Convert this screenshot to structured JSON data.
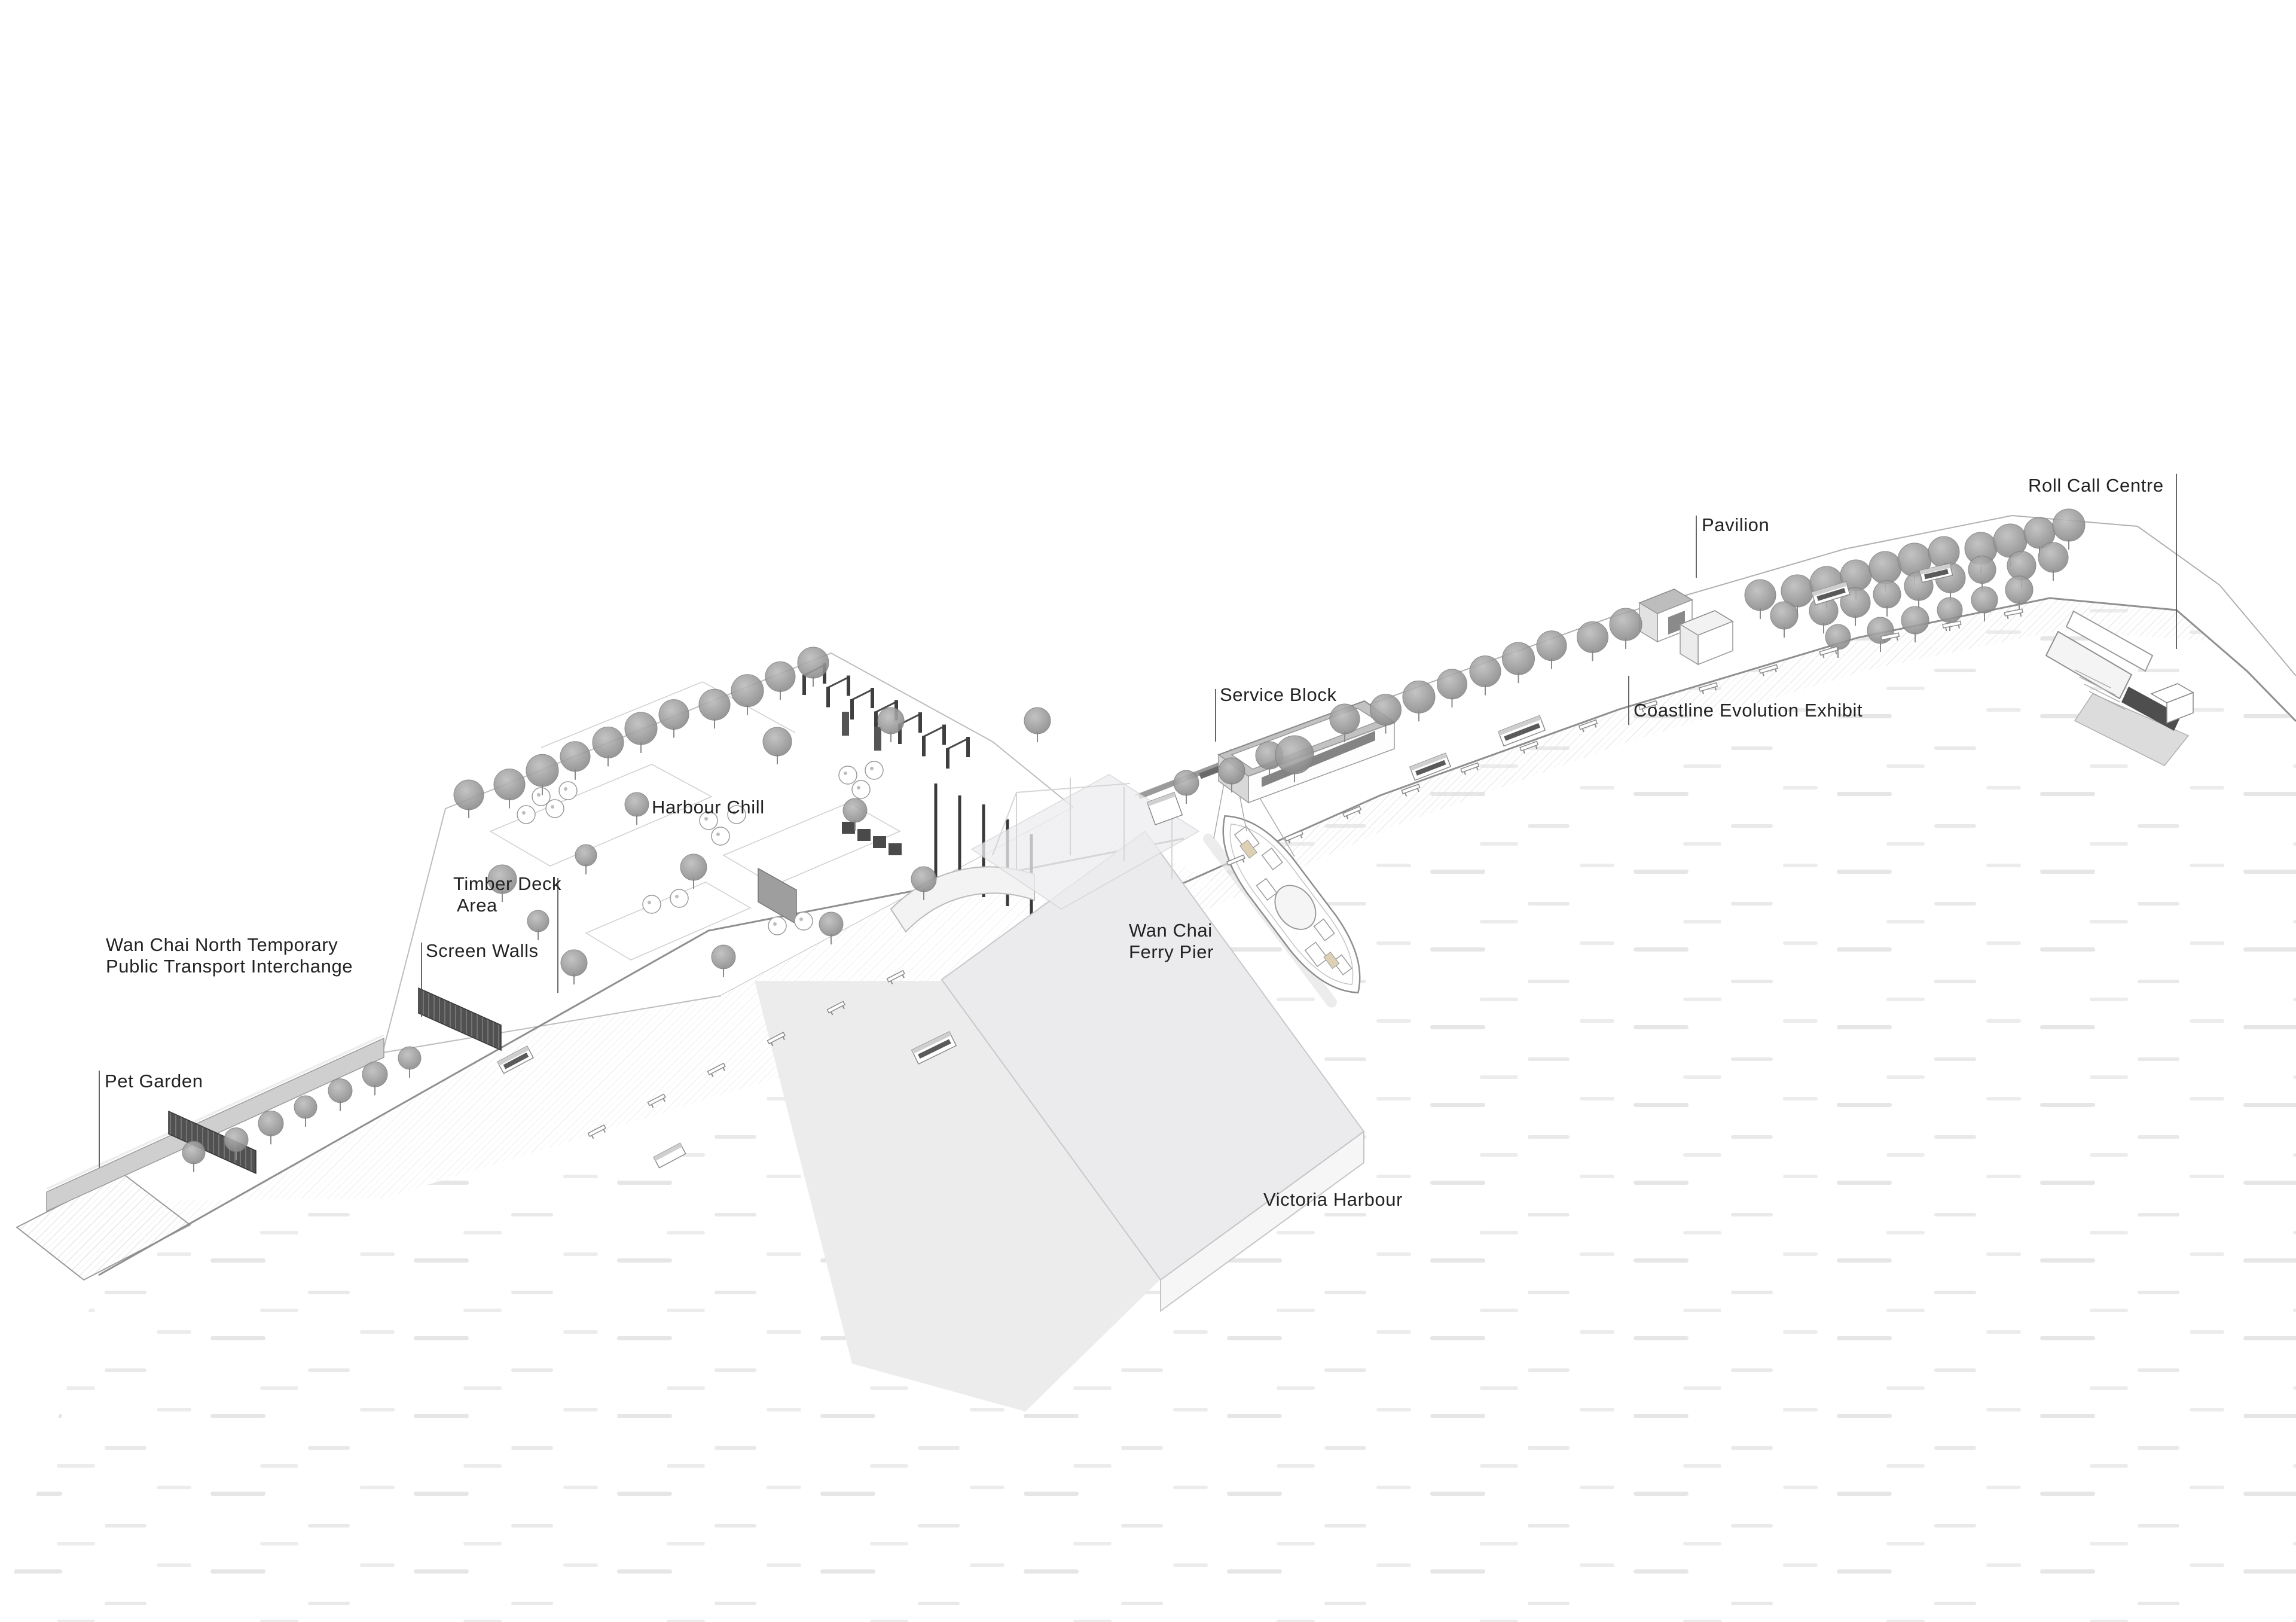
{
  "title": "Wan Chai Ferry Pier Waterfront — Axonometric Site Plan",
  "labels": {
    "roll_call_centre": {
      "text": "Roll Call Centre"
    },
    "pavilion": {
      "text": "Pavilion"
    },
    "service_block": {
      "text": "Service Block"
    },
    "coastline_evolution_exhibit": {
      "text": "Coastline Evolution Exhibit"
    },
    "harbour_chill": {
      "text": "Harbour Chill"
    },
    "timber_deck_area": {
      "line1": "Timber Deck",
      "line2": "Area"
    },
    "screen_walls": {
      "text": "Screen Walls"
    },
    "transport_interchange": {
      "line1": "Wan Chai North Temporary",
      "line2": "Public Transport Interchange"
    },
    "pet_garden": {
      "text": "Pet Garden"
    },
    "ferry_pier": {
      "line1": "Wan Chai",
      "line2": "Ferry Pier"
    },
    "victoria_harbour": {
      "text": "Victoria Harbour"
    }
  },
  "colors": {
    "background": "#ffffff",
    "label_text": "#222222",
    "water_dash": "#e6e6e6",
    "seawall_line": "#8f8f8f",
    "back_edge_line": "#b0b0b0",
    "pier_fill": "#ebebee",
    "pier_shadow": "#ececec",
    "tree_gray": "#8f8f8f",
    "dark_structure": "#4a4a4a",
    "viaduct_gray": "#cfcfcf",
    "boat_accent_beige": "#ddd0b4"
  }
}
